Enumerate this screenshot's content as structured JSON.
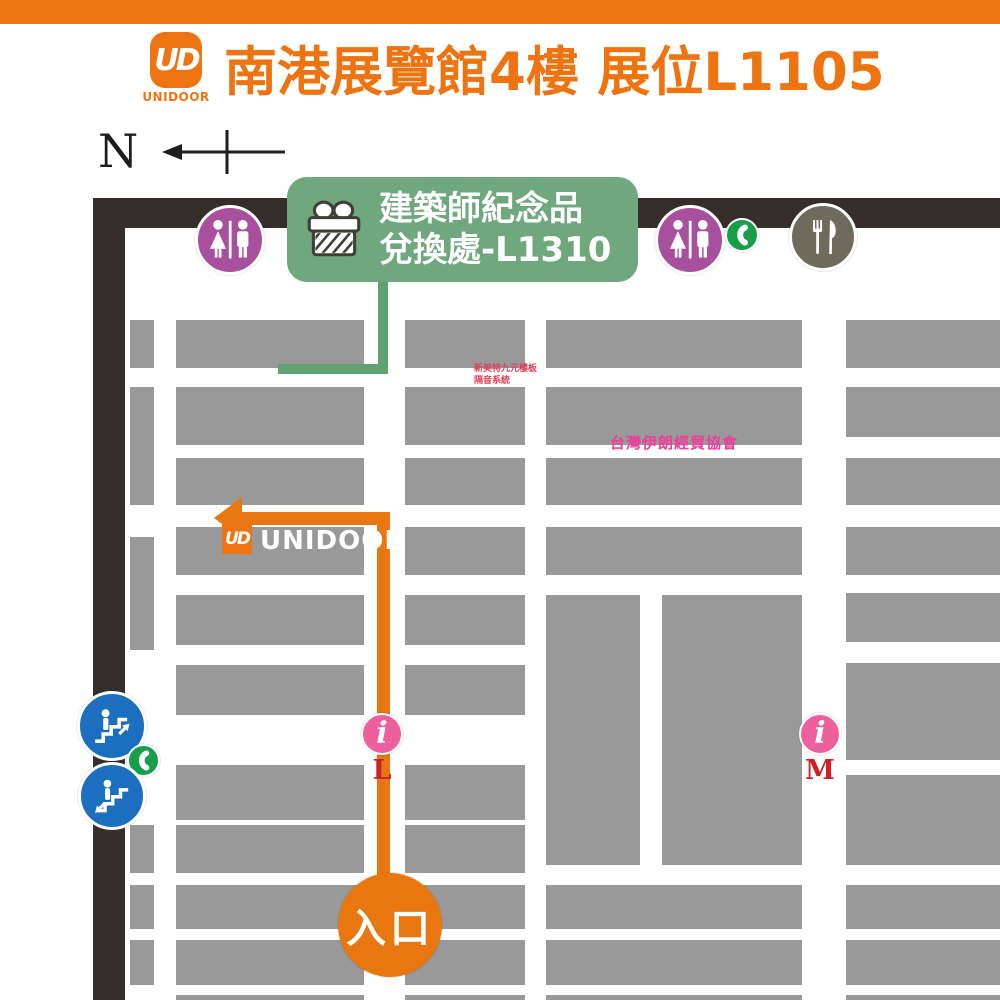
{
  "header": {
    "title": "南港展覽館4樓 展位L1105",
    "logo_monogram": "UD",
    "logo_caption": "UNIDOOR"
  },
  "compass": {
    "north_label": "N"
  },
  "gift_banner": {
    "line1": "建築師紀念品",
    "line2": "兌換處-L1310"
  },
  "map": {
    "colors": {
      "brand_orange": "#ed7411",
      "booth_gray": "#999999",
      "wall_dark": "#362e2b",
      "banner_green": "#6fa87d",
      "route_orange": "#e87710",
      "restroom_purple": "#a84f9e",
      "phone_green": "#179e4a",
      "restaurant_olive": "#6e6a5c",
      "escalator_blue": "#1b6fbe",
      "info_pink": "#ee5f9d",
      "marker_red": "#cc2127"
    },
    "unidoor_booth": {
      "monogram": "UD",
      "label": "UNIDOOR"
    },
    "vendor_labels": [
      {
        "text": "新美特九元樓板\n隔音系統"
      },
      {
        "text": "台灣伊朗經貿協會"
      }
    ],
    "info_glyph": "i",
    "info_markers": [
      {
        "letter": "L"
      },
      {
        "letter": "M"
      }
    ],
    "entrance_label": "入口",
    "booths": [
      [
        130,
        320,
        24,
        48
      ],
      [
        130,
        387,
        24,
        118
      ],
      [
        130,
        537,
        24,
        113
      ],
      [
        130,
        825,
        24,
        48
      ],
      [
        130,
        885,
        24,
        44
      ],
      [
        130,
        940,
        24,
        45
      ],
      [
        176,
        320,
        188,
        48
      ],
      [
        176,
        387,
        188,
        58
      ],
      [
        176,
        458,
        188,
        47
      ],
      [
        176,
        527,
        188,
        48
      ],
      [
        176,
        595,
        188,
        50
      ],
      [
        176,
        665,
        188,
        50
      ],
      [
        176,
        765,
        188,
        55
      ],
      [
        176,
        825,
        188,
        48
      ],
      [
        176,
        885,
        188,
        44
      ],
      [
        176,
        940,
        188,
        45
      ],
      [
        176,
        995,
        188,
        5
      ],
      [
        405,
        320,
        120,
        48
      ],
      [
        405,
        387,
        120,
        58
      ],
      [
        405,
        458,
        120,
        47
      ],
      [
        405,
        527,
        120,
        48
      ],
      [
        405,
        595,
        120,
        50
      ],
      [
        405,
        665,
        120,
        50
      ],
      [
        405,
        765,
        120,
        55
      ],
      [
        405,
        825,
        120,
        48
      ],
      [
        405,
        885,
        120,
        44
      ],
      [
        405,
        940,
        120,
        45
      ],
      [
        405,
        995,
        120,
        5
      ],
      [
        546,
        320,
        256,
        48
      ],
      [
        546,
        387,
        256,
        58
      ],
      [
        546,
        458,
        256,
        47
      ],
      [
        546,
        527,
        256,
        48
      ],
      [
        546,
        595,
        94,
        270
      ],
      [
        662,
        595,
        140,
        270
      ],
      [
        546,
        885,
        256,
        44
      ],
      [
        546,
        940,
        256,
        45
      ],
      [
        546,
        995,
        256,
        5
      ],
      [
        846,
        320,
        154,
        48
      ],
      [
        846,
        387,
        154,
        50
      ],
      [
        846,
        458,
        154,
        47
      ],
      [
        846,
        527,
        154,
        48
      ],
      [
        846,
        593,
        154,
        49
      ],
      [
        846,
        663,
        154,
        97
      ],
      [
        846,
        775,
        154,
        90
      ],
      [
        846,
        885,
        154,
        44
      ],
      [
        846,
        940,
        154,
        45
      ],
      [
        846,
        995,
        154,
        5
      ]
    ]
  }
}
